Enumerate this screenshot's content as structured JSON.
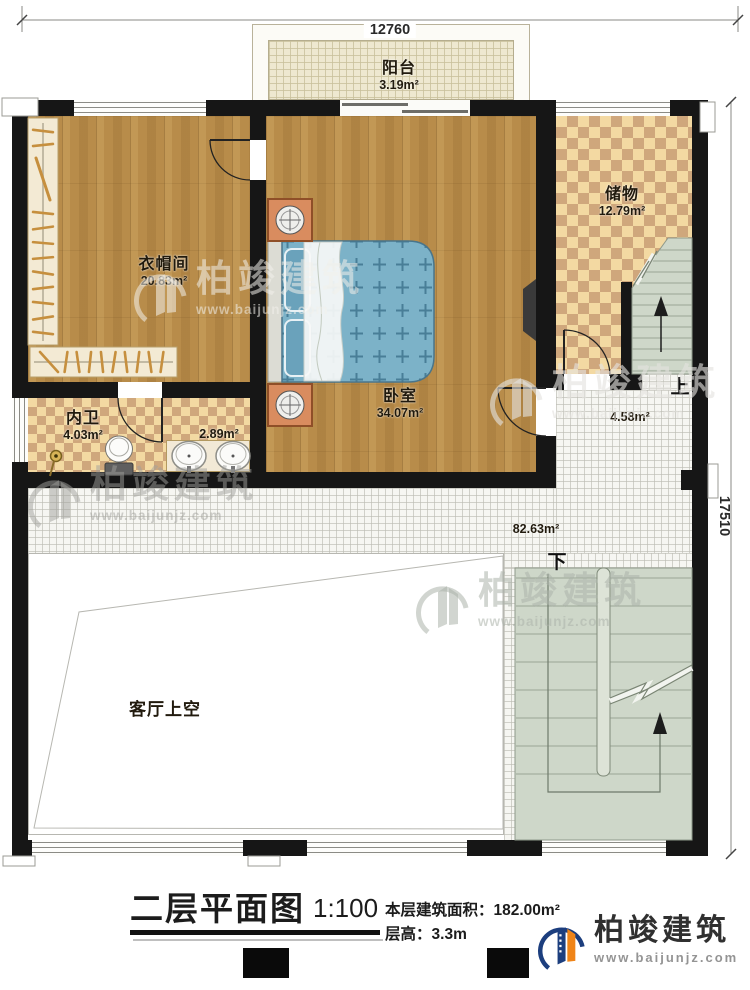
{
  "dim_top": "12760",
  "dim_right": "17510",
  "rooms": {
    "balcony": {
      "name": "阳台",
      "area": "3.19m²"
    },
    "cloakroom": {
      "name": "衣帽间",
      "area": "20.83m²"
    },
    "bedroom": {
      "name": "卧室",
      "area": "34.07m²"
    },
    "storage": {
      "name": "储物",
      "area": "12.79m²"
    },
    "bathroom": {
      "name": "内卫",
      "area": "4.03m²"
    },
    "vanity": {
      "area": "2.89m²"
    },
    "stair_hall": {
      "area": "4.58m²"
    },
    "hall": {
      "area": "82.63m²"
    },
    "living_void": {
      "name": "客厅上空"
    }
  },
  "stairs": {
    "up_label": "上",
    "down_label": "下"
  },
  "title_block": {
    "title": "二层平面图",
    "scale": "1:100",
    "area_label": "本层建筑面积：",
    "area_value": "182.00m²",
    "floor_height_label": "层高：",
    "floor_height_value": "3.3m"
  },
  "branding": {
    "company": "柏竣建筑",
    "website": "www.baijunjz.com"
  },
  "colors": {
    "wall": "#161616",
    "wood_floor": "#b88c4a",
    "checker_light": "#f3d9a2",
    "checker_dark": "#cfa77c",
    "tile_floor": "#f6f6f2",
    "stair": "#ced7c9",
    "bed": "#7cb2c8",
    "logo_blue": "#1c3e7e",
    "logo_orange": "#ef8418"
  }
}
